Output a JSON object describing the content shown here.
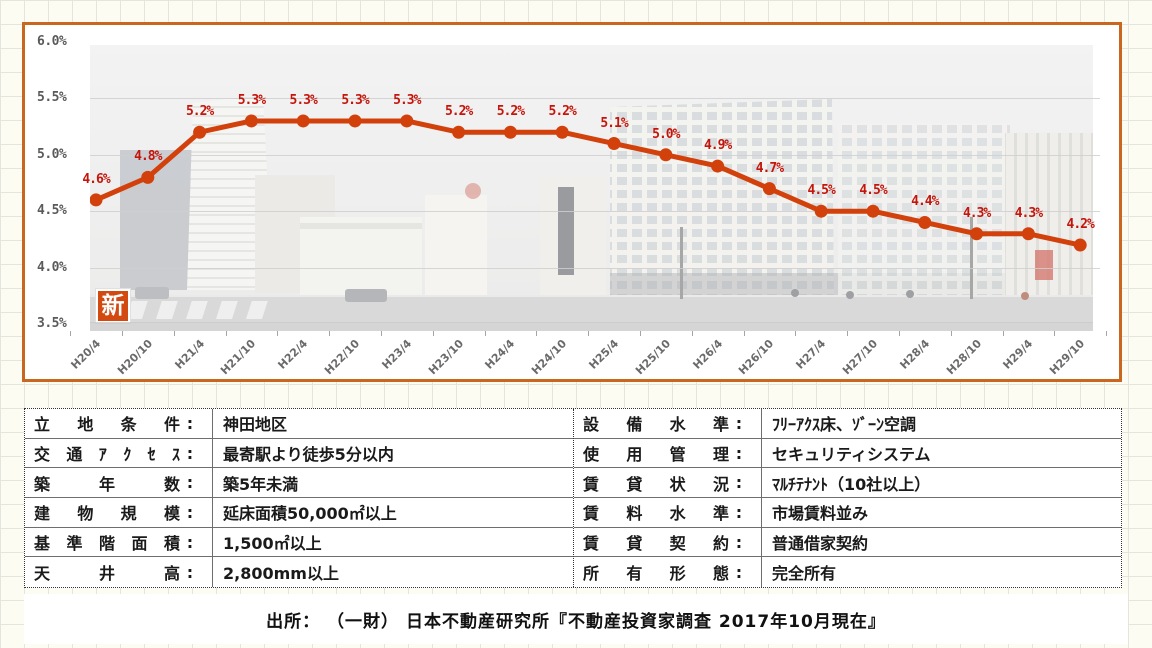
{
  "chart_data": {
    "type": "line",
    "title": "",
    "categories": [
      "H20/4",
      "H20/10",
      "H21/4",
      "H21/10",
      "H22/4",
      "H22/10",
      "H23/4",
      "H23/10",
      "H24/4",
      "H24/10",
      "H25/4",
      "H25/10",
      "H26/4",
      "H26/10",
      "H27/4",
      "H27/10",
      "H28/4",
      "H28/10",
      "H29/4",
      "H29/10"
    ],
    "values": [
      4.6,
      4.8,
      5.2,
      5.3,
      5.3,
      5.3,
      5.3,
      5.2,
      5.2,
      5.2,
      5.1,
      5.0,
      4.9,
      4.7,
      4.5,
      4.5,
      4.4,
      4.3,
      4.3,
      4.2
    ],
    "value_suffix": "%",
    "yticks": [
      "6.0%",
      "5.5%",
      "5.0%",
      "4.5%",
      "4.0%",
      "3.5%"
    ],
    "ylim": [
      3.5,
      6.0
    ],
    "grid": true,
    "legend": "none",
    "line_color": "#d2410c",
    "point_label_color": "#c5150b",
    "frame_border_color": "#c8671d",
    "badge_label": "新",
    "badge_color": "#d24a10",
    "background": "faded city street photo of office buildings"
  },
  "table": {
    "colon": ":",
    "left": {
      "rows": [
        {
          "label": "立地条件",
          "value": "神田地区"
        },
        {
          "label": "交通ｱｸｾｽ",
          "value": "最寄駅より徒歩5分以内"
        },
        {
          "label": "築年数",
          "value": "築5年未満"
        },
        {
          "label": "建物規模",
          "value": "延床面積50,000㎡以上"
        },
        {
          "label": "基準階面積",
          "value": "1,500㎡以上"
        },
        {
          "label": "天井高",
          "value": "2,800mm以上"
        }
      ]
    },
    "right": {
      "rows": [
        {
          "label": "設備水準",
          "value": "ﾌﾘｰｱｸｽ床、ｿﾞｰﾝ空調"
        },
        {
          "label": "使用管理",
          "value": "セキュリティシステム"
        },
        {
          "label": "賃貸状況",
          "value": "ﾏﾙﾁﾃﾅﾝﾄ（10社以上）"
        },
        {
          "label": "賃料水準",
          "value": "市場賃料並み"
        },
        {
          "label": "賃貸契約",
          "value": "普通借家契約"
        },
        {
          "label": "所有形態",
          "value": "完全所有"
        }
      ]
    }
  },
  "source": {
    "text": "出所： （一財） 日本不動産研究所『不動産投資家調査 2017年10月現在』"
  }
}
